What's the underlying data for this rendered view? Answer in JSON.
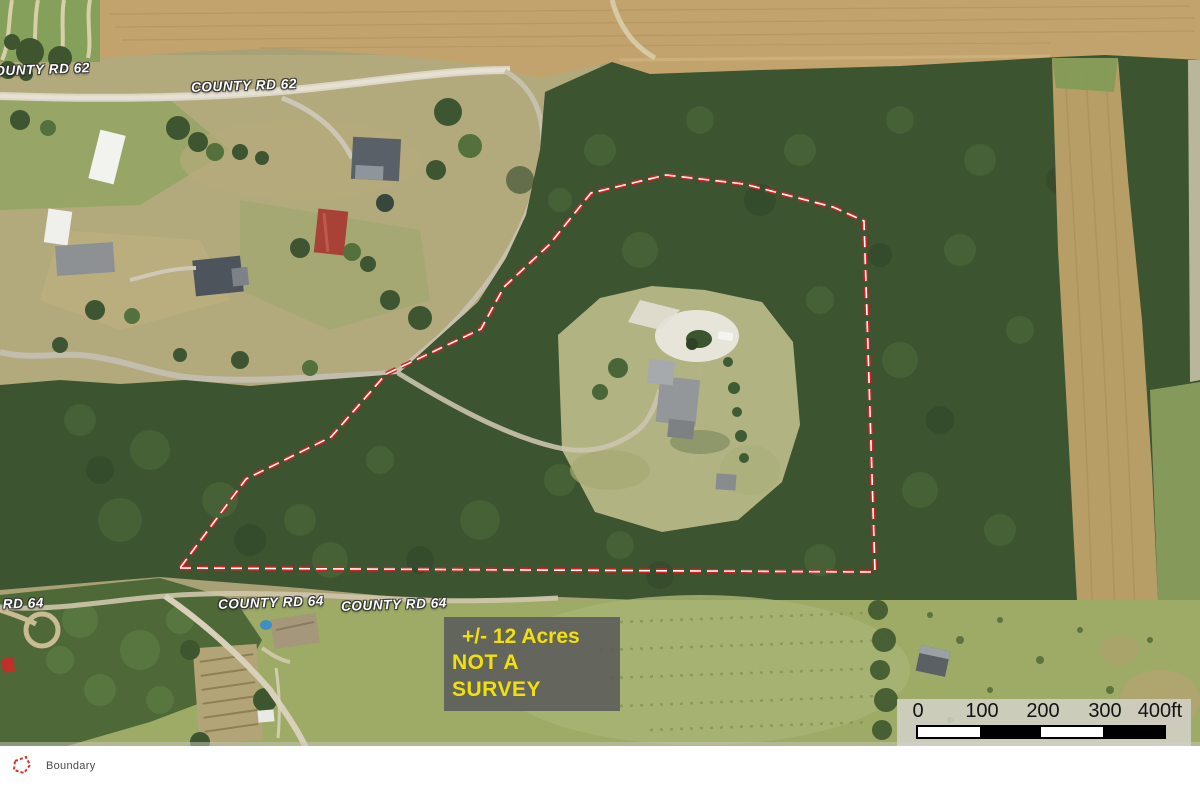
{
  "roads": {
    "labels": [
      "COUNTY RD 62",
      "COUNTY RD 62",
      "COUNTY RD 64",
      "COUNTY RD 64",
      "COUNTY RD 64"
    ]
  },
  "annotation": {
    "acreage": "+/- 12 Acres",
    "disclaimer": "NOT A SURVEY"
  },
  "scale_bar": {
    "ticks": [
      "0",
      "100",
      "200",
      "300",
      "400ft"
    ]
  },
  "legend": {
    "items": [
      {
        "label": "Boundary",
        "symbol": "red-dashed-polygon"
      }
    ]
  },
  "colors": {
    "boundary_red": "#d81e20",
    "boundary_core": "#ffffff",
    "annotation_text": "#f2e00d",
    "annotation_bg": "#58585a",
    "road_label_text": "#ffffff",
    "scalebar_bg": "#d6d3cd",
    "forest_green": "#3c5430",
    "field_tan": "#c2a36d"
  }
}
